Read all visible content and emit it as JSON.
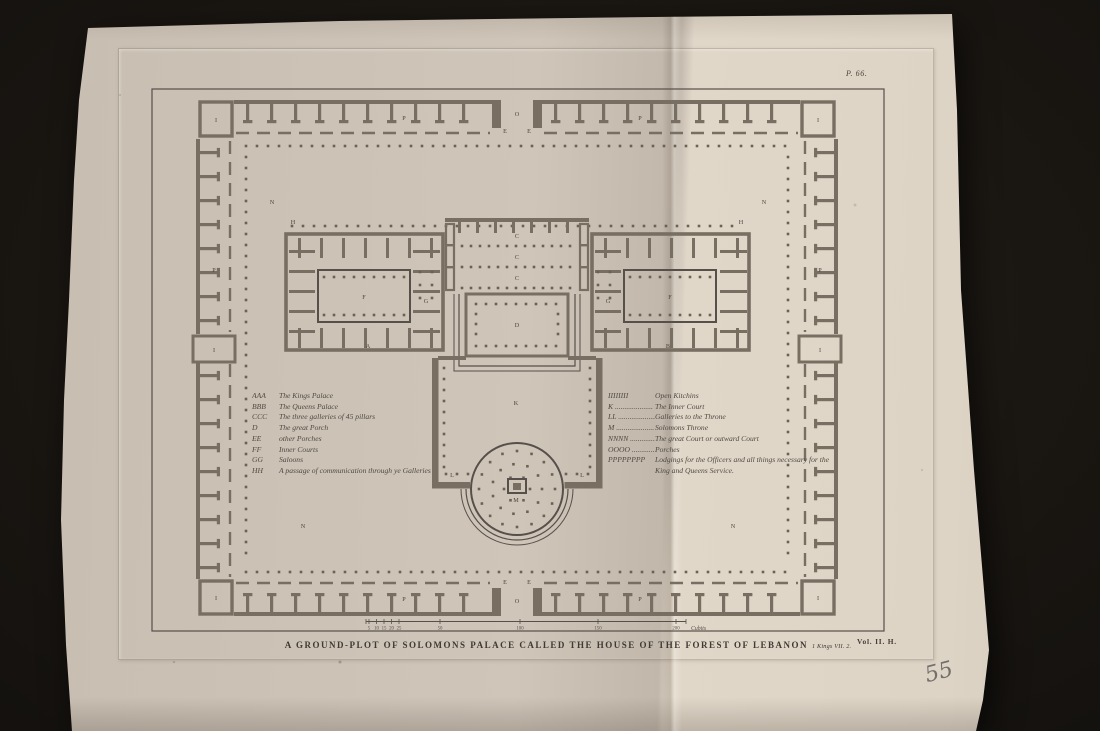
{
  "photo": {
    "background": "#15110d",
    "paper_left": "#cfc5b9",
    "paper_right": "#e1d7c9",
    "ink": "#57504a",
    "wall": "#786e62",
    "dot": "#6b6257"
  },
  "plate": {
    "number": "P. 66.",
    "volume": "Vol. II. H."
  },
  "title": {
    "main": "A GROUND-PLOT OF SOLOMONS PALACE CALLED THE HOUSE OF THE FOREST OF LEBANON",
    "reference": "1 Kings VII. 2."
  },
  "legend_left": [
    {
      "key": "AAA",
      "text": "The Kings Palace"
    },
    {
      "key": "BBB",
      "text": "The Queens Palace"
    },
    {
      "key": "CCC",
      "text": "The three galleries of 45 pillars"
    },
    {
      "key": "D",
      "text": "The great Porch"
    },
    {
      "key": "EE",
      "text": "other Porches"
    },
    {
      "key": "FF",
      "text": "Inner Courts"
    },
    {
      "key": "GG",
      "text": "Saloons"
    },
    {
      "key": "HH",
      "text": "A passage of communication through ye Galleries"
    }
  ],
  "legend_right": [
    {
      "key": "IIIIIIII",
      "text": "Open Kitchins"
    },
    {
      "key": "K",
      "text": "The Inner Court"
    },
    {
      "key": "LL",
      "text": "Galleries to the Throne"
    },
    {
      "key": "M",
      "text": "Solomons Throne"
    },
    {
      "key": "NNNN",
      "text": "The great Court or outward Court"
    },
    {
      "key": "OOOO",
      "text": "Porches"
    },
    {
      "key": "PPPPPPPP",
      "text": "Lodgings for the Officers and all things necessary for the King and Queens Service."
    }
  ],
  "scale_bar": {
    "unit": "Cubits",
    "ticks": [
      "5",
      "10",
      "15",
      "20",
      "25",
      "50",
      "100",
      "150",
      "200"
    ]
  },
  "plan_labels": [
    {
      "t": "O",
      "x": 517,
      "y": 116
    },
    {
      "t": "O",
      "x": 517,
      "y": 603
    },
    {
      "t": "E",
      "x": 505,
      "y": 133
    },
    {
      "t": "E",
      "x": 529,
      "y": 133
    },
    {
      "t": "E",
      "x": 505,
      "y": 584
    },
    {
      "t": "E",
      "x": 529,
      "y": 584
    },
    {
      "t": "N",
      "x": 272,
      "y": 204
    },
    {
      "t": "N",
      "x": 764,
      "y": 204
    },
    {
      "t": "N",
      "x": 303,
      "y": 528
    },
    {
      "t": "N",
      "x": 733,
      "y": 528
    },
    {
      "t": "P",
      "x": 404,
      "y": 120
    },
    {
      "t": "P",
      "x": 640,
      "y": 120
    },
    {
      "t": "P",
      "x": 214,
      "y": 272
    },
    {
      "t": "P",
      "x": 820,
      "y": 272
    },
    {
      "t": "P",
      "x": 404,
      "y": 601
    },
    {
      "t": "P",
      "x": 640,
      "y": 601
    },
    {
      "t": "I",
      "x": 216,
      "y": 122
    },
    {
      "t": "I",
      "x": 818,
      "y": 122
    },
    {
      "t": "I",
      "x": 216,
      "y": 600
    },
    {
      "t": "I",
      "x": 818,
      "y": 600
    },
    {
      "t": "I",
      "x": 214,
      "y": 352
    },
    {
      "t": "I",
      "x": 820,
      "y": 352
    },
    {
      "t": "A",
      "x": 368,
      "y": 348
    },
    {
      "t": "B",
      "x": 668,
      "y": 348
    },
    {
      "t": "C",
      "x": 517,
      "y": 238
    },
    {
      "t": "C",
      "x": 517,
      "y": 259
    },
    {
      "t": "C",
      "x": 517,
      "y": 280
    },
    {
      "t": "D",
      "x": 517,
      "y": 327
    },
    {
      "t": "F",
      "x": 364,
      "y": 299
    },
    {
      "t": "F",
      "x": 670,
      "y": 299
    },
    {
      "t": "G",
      "x": 426,
      "y": 303
    },
    {
      "t": "G",
      "x": 608,
      "y": 303
    },
    {
      "t": "H",
      "x": 293,
      "y": 224
    },
    {
      "t": "H",
      "x": 741,
      "y": 224
    },
    {
      "t": "K",
      "x": 516,
      "y": 405
    },
    {
      "t": "L",
      "x": 452,
      "y": 477
    },
    {
      "t": "L",
      "x": 582,
      "y": 477
    },
    {
      "t": "M",
      "x": 516,
      "y": 502
    }
  ],
  "annotations": {
    "pencil": "55"
  }
}
